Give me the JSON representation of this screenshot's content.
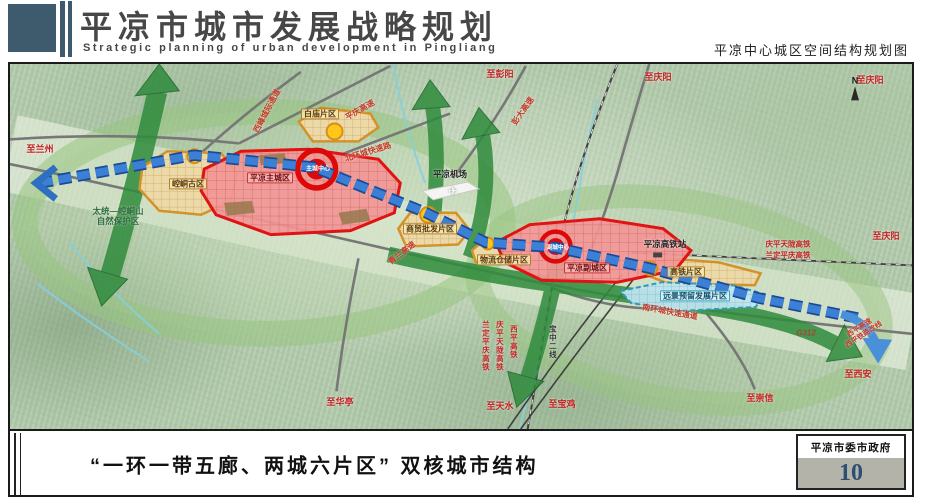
{
  "header": {
    "title": "平凉市城市发展战略规划",
    "subtitle_en": "Strategic planning of urban development in Pingliang",
    "caption_right": "平凉中心城区空间结构规划图"
  },
  "map": {
    "compass": "N",
    "district_labels": {
      "kongtong": "崆峒古区",
      "baimiao": "白庙片区",
      "main_city": "平凉主城区",
      "trade": "商贸批发片区",
      "logistics": "物流仓储片区",
      "sub_city": "平凉副城区",
      "hsr": "高铁片区",
      "reserve": "远景预留发展片区"
    },
    "cores": {
      "main": "主城中心",
      "sub": "副城中心"
    },
    "pois": {
      "airport": "平凉机场",
      "hsr_station": "平凉高铁站",
      "nature_reserve_1": "太统—崆峒山",
      "nature_reserve_2": "自然保护区"
    },
    "roads": {
      "g312": "G312",
      "north_ring": "北环城快速路",
      "south_ring": "南环城快速通道",
      "pengda": "彭大高速",
      "pingqing": "平庆高速",
      "qinglan": "青兰高速",
      "xifeng": "西峰城际通道",
      "xiping_hw": "西平高速",
      "xiping_rail_reroute": "西平铁路改线"
    },
    "rails": {
      "qptl_1": "庆平天陇高铁",
      "ldpq_1": "兰定平庆高铁",
      "qptl_2": "庆平天陇高铁",
      "ldpq_2": "兰定平庆高铁",
      "xiping": "西平高铁",
      "baozhong": "宝中二线"
    },
    "directions": {
      "lanzhou": "至兰州",
      "pengyang": "至彭阳",
      "qingyang_top": "至庆阳",
      "qingyang_corner": "至庆阳",
      "qingyang_right": "至庆阳",
      "xian": "至西安",
      "chongxin": "至崇信",
      "baoji": "至宝鸡",
      "tianshui": "至天水",
      "huating": "至华亭"
    }
  },
  "footer": {
    "caption": "“一环一带五廊、两城六片区” 双核城市结构",
    "agency": "平凉市委市政府",
    "page_number": "10"
  },
  "colors": {
    "header_slate": "#3e5a6d",
    "district_red": "#e01212",
    "district_orange": "#d4932a",
    "axis_blue": "#2e6fc0",
    "corridor_green": "#2f8b3c",
    "page_number_blue": "#2c4f74"
  }
}
